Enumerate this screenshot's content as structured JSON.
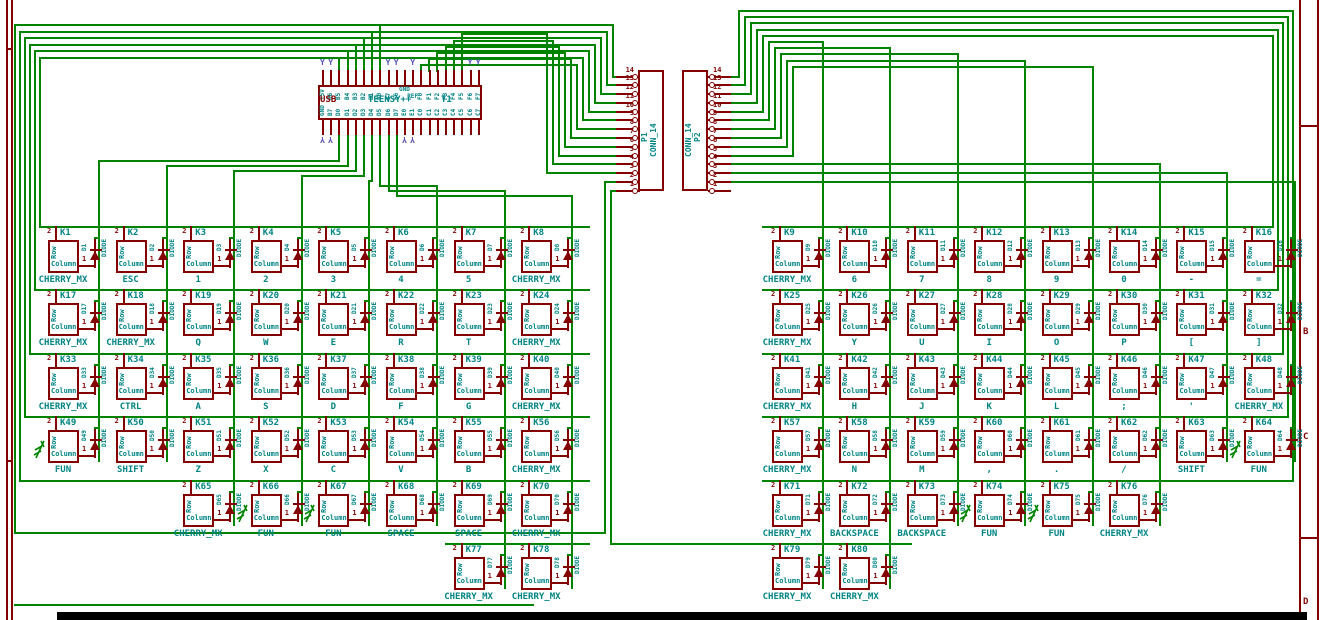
{
  "colors": {
    "wire": "#008400",
    "outline": "#840000",
    "text": "#008484",
    "noconnect": "#5252b5",
    "background": "#ffffff",
    "frame": "#840000",
    "bottom_bar": "#000000"
  },
  "schematic": {
    "teensy": {
      "ref": "T1",
      "value": "TEENSY++",
      "left_label": "USB",
      "top_pins": [
        "+5V",
        "B6",
        "B5",
        "B4",
        "B3",
        "B2",
        "B1",
        "B0",
        "E7",
        "E6",
        "GND",
        "REF",
        "F0",
        "F1",
        "F2",
        "F3",
        "F4",
        "F5",
        "F6",
        "F7"
      ],
      "bottom_pins": [
        "GND",
        "B7",
        "D0",
        "D1",
        "D2",
        "D3",
        "D4",
        "D5",
        "D6",
        "D7",
        "E0",
        "E1",
        "C0",
        "C1",
        "C2",
        "C3",
        "C4",
        "C5",
        "C6",
        "C7"
      ],
      "nc_top": [
        0,
        1,
        8,
        9,
        11,
        18,
        19
      ],
      "nc_bottom": [
        0,
        1,
        10,
        11
      ]
    },
    "connectors": [
      {
        "ref": "P1",
        "value": "CONN_14",
        "pin_numbers": [
          "14",
          "13",
          "12",
          "11",
          "10",
          "9",
          "8",
          "7",
          "6",
          "5",
          "4",
          "3",
          "2",
          "1"
        ]
      },
      {
        "ref": "P2",
        "value": "CONN_14",
        "pin_numbers": [
          "14",
          "13",
          "12",
          "11",
          "10",
          "9",
          "8",
          "7",
          "6",
          "5",
          "4",
          "3",
          "2",
          "1"
        ]
      }
    ],
    "switch_labels": {
      "pin2_name": "Row",
      "pin1_name": "Column",
      "pin1_num": "1",
      "pin2_num": "2",
      "diode_value": "DIODE"
    },
    "keys": [
      {
        "ref": "K1",
        "value": "CHERRY_MX",
        "diode": "D1",
        "half": "L",
        "row": 1,
        "col": 0
      },
      {
        "ref": "K2",
        "value": "ESC",
        "diode": "D2",
        "half": "L",
        "row": 1,
        "col": 1
      },
      {
        "ref": "K3",
        "value": "1",
        "diode": "D3",
        "half": "L",
        "row": 1,
        "col": 2
      },
      {
        "ref": "K4",
        "value": "2",
        "diode": "D4",
        "half": "L",
        "row": 1,
        "col": 3
      },
      {
        "ref": "K5",
        "value": "3",
        "diode": "D5",
        "half": "L",
        "row": 1,
        "col": 4
      },
      {
        "ref": "K6",
        "value": "4",
        "diode": "D6",
        "half": "L",
        "row": 1,
        "col": 5
      },
      {
        "ref": "K7",
        "value": "5",
        "diode": "D7",
        "half": "L",
        "row": 1,
        "col": 6
      },
      {
        "ref": "K8",
        "value": "CHERRY_MX",
        "diode": "D8",
        "half": "L",
        "row": 1,
        "col": 7
      },
      {
        "ref": "K9",
        "value": "CHERRY_MX",
        "diode": "D9",
        "half": "R",
        "row": 1,
        "col": 0
      },
      {
        "ref": "K10",
        "value": "6",
        "diode": "D10",
        "half": "R",
        "row": 1,
        "col": 1
      },
      {
        "ref": "K11",
        "value": "7",
        "diode": "D11",
        "half": "R",
        "row": 1,
        "col": 2
      },
      {
        "ref": "K12",
        "value": "8",
        "diode": "D12",
        "half": "R",
        "row": 1,
        "col": 3
      },
      {
        "ref": "K13",
        "value": "9",
        "diode": "D13",
        "half": "R",
        "row": 1,
        "col": 4
      },
      {
        "ref": "K14",
        "value": "0",
        "diode": "D14",
        "half": "R",
        "row": 1,
        "col": 5
      },
      {
        "ref": "K15",
        "value": "-",
        "diode": "D15",
        "half": "R",
        "row": 1,
        "col": 6
      },
      {
        "ref": "K16",
        "value": "=",
        "diode": "D16",
        "half": "R",
        "row": 1,
        "col": 7
      },
      {
        "ref": "K17",
        "value": "CHERRY_MX",
        "diode": "D17",
        "half": "L",
        "row": 2,
        "col": 0
      },
      {
        "ref": "K18",
        "value": "CHERRY_MX",
        "diode": "D18",
        "half": "L",
        "row": 2,
        "col": 1
      },
      {
        "ref": "K19",
        "value": "Q",
        "diode": "D19",
        "half": "L",
        "row": 2,
        "col": 2
      },
      {
        "ref": "K20",
        "value": "W",
        "diode": "D20",
        "half": "L",
        "row": 2,
        "col": 3
      },
      {
        "ref": "K21",
        "value": "E",
        "diode": "D21",
        "half": "L",
        "row": 2,
        "col": 4
      },
      {
        "ref": "K22",
        "value": "R",
        "diode": "D22",
        "half": "L",
        "row": 2,
        "col": 5
      },
      {
        "ref": "K23",
        "value": "T",
        "diode": "D23",
        "half": "L",
        "row": 2,
        "col": 6
      },
      {
        "ref": "K24",
        "value": "CHERRY_MX",
        "diode": "D24",
        "half": "L",
        "row": 2,
        "col": 7
      },
      {
        "ref": "K25",
        "value": "CHERRY_MX",
        "diode": "D25",
        "half": "R",
        "row": 2,
        "col": 0
      },
      {
        "ref": "K26",
        "value": "Y",
        "diode": "D26",
        "half": "R",
        "row": 2,
        "col": 1
      },
      {
        "ref": "K27",
        "value": "U",
        "diode": "D27",
        "half": "R",
        "row": 2,
        "col": 2
      },
      {
        "ref": "K28",
        "value": "I",
        "diode": "D28",
        "half": "R",
        "row": 2,
        "col": 3
      },
      {
        "ref": "K29",
        "value": "O",
        "diode": "D29",
        "half": "R",
        "row": 2,
        "col": 4
      },
      {
        "ref": "K30",
        "value": "P",
        "diode": "D30",
        "half": "R",
        "row": 2,
        "col": 5
      },
      {
        "ref": "K31",
        "value": "[",
        "diode": "D31",
        "half": "R",
        "row": 2,
        "col": 6
      },
      {
        "ref": "K32",
        "value": "]",
        "diode": "D32",
        "half": "R",
        "row": 2,
        "col": 7
      },
      {
        "ref": "K33",
        "value": "CHERRY_MX",
        "diode": "D33",
        "half": "L",
        "row": 3,
        "col": 0
      },
      {
        "ref": "K34",
        "value": "CTRL",
        "diode": "D34",
        "half": "L",
        "row": 3,
        "col": 1
      },
      {
        "ref": "K35",
        "value": "A",
        "diode": "D35",
        "half": "L",
        "row": 3,
        "col": 2
      },
      {
        "ref": "K36",
        "value": "S",
        "diode": "D36",
        "half": "L",
        "row": 3,
        "col": 3
      },
      {
        "ref": "K37",
        "value": "D",
        "diode": "D37",
        "half": "L",
        "row": 3,
        "col": 4
      },
      {
        "ref": "K38",
        "value": "F",
        "diode": "D38",
        "half": "L",
        "row": 3,
        "col": 5
      },
      {
        "ref": "K39",
        "value": "G",
        "diode": "D39",
        "half": "L",
        "row": 3,
        "col": 6
      },
      {
        "ref": "K40",
        "value": "CHERRY_MX",
        "diode": "D40",
        "half": "L",
        "row": 3,
        "col": 7
      },
      {
        "ref": "K41",
        "value": "CHERRY_MX",
        "diode": "D41",
        "half": "R",
        "row": 3,
        "col": 0
      },
      {
        "ref": "K42",
        "value": "H",
        "diode": "D42",
        "half": "R",
        "row": 3,
        "col": 1
      },
      {
        "ref": "K43",
        "value": "J",
        "diode": "D43",
        "half": "R",
        "row": 3,
        "col": 2
      },
      {
        "ref": "K44",
        "value": "K",
        "diode": "D44",
        "half": "R",
        "row": 3,
        "col": 3
      },
      {
        "ref": "K45",
        "value": "L",
        "diode": "D45",
        "half": "R",
        "row": 3,
        "col": 4
      },
      {
        "ref": "K46",
        "value": ";",
        "diode": "D46",
        "half": "R",
        "row": 3,
        "col": 5
      },
      {
        "ref": "K47",
        "value": "'",
        "diode": "D47",
        "half": "R",
        "row": 3,
        "col": 6
      },
      {
        "ref": "K48",
        "value": "CHERRY_MX",
        "diode": "D48",
        "half": "R",
        "row": 3,
        "col": 7
      },
      {
        "ref": "K49",
        "value": "FUN",
        "diode": "D49",
        "half": "L",
        "row": 4,
        "col": 0,
        "arrow": true
      },
      {
        "ref": "K50",
        "value": "SHIFT",
        "diode": "D50",
        "half": "L",
        "row": 4,
        "col": 1
      },
      {
        "ref": "K51",
        "value": "Z",
        "diode": "D51",
        "half": "L",
        "row": 4,
        "col": 2
      },
      {
        "ref": "K52",
        "value": "X",
        "diode": "D52",
        "half": "L",
        "row": 4,
        "col": 3
      },
      {
        "ref": "K53",
        "value": "C",
        "diode": "D53",
        "half": "L",
        "row": 4,
        "col": 4
      },
      {
        "ref": "K54",
        "value": "V",
        "diode": "D54",
        "half": "L",
        "row": 4,
        "col": 5
      },
      {
        "ref": "K55",
        "value": "B",
        "diode": "D55",
        "half": "L",
        "row": 4,
        "col": 6
      },
      {
        "ref": "K56",
        "value": "CHERRY_MX",
        "diode": "D56",
        "half": "L",
        "row": 4,
        "col": 7
      },
      {
        "ref": "K57",
        "value": "CHERRY_MX",
        "diode": "D57",
        "half": "R",
        "row": 4,
        "col": 0
      },
      {
        "ref": "K58",
        "value": "N",
        "diode": "D58",
        "half": "R",
        "row": 4,
        "col": 1
      },
      {
        "ref": "K59",
        "value": "M",
        "diode": "D59",
        "half": "R",
        "row": 4,
        "col": 2
      },
      {
        "ref": "K60",
        "value": ",",
        "diode": "D60",
        "half": "R",
        "row": 4,
        "col": 3
      },
      {
        "ref": "K61",
        "value": ".",
        "diode": "D61",
        "half": "R",
        "row": 4,
        "col": 4
      },
      {
        "ref": "K62",
        "value": "/",
        "diode": "D62",
        "half": "R",
        "row": 4,
        "col": 5
      },
      {
        "ref": "K63",
        "value": "SHIFT",
        "diode": "D63",
        "half": "R",
        "row": 4,
        "col": 6
      },
      {
        "ref": "K64",
        "value": "FUN",
        "diode": "D64",
        "half": "R",
        "row": 4,
        "col": 7,
        "arrow": true
      },
      {
        "ref": "K65",
        "value": "CHERRY_MX",
        "diode": "D65",
        "half": "L",
        "row": 5,
        "col": 2
      },
      {
        "ref": "K66",
        "value": "FUN",
        "diode": "D66",
        "half": "L",
        "row": 5,
        "col": 3,
        "arrow": true
      },
      {
        "ref": "K67",
        "value": "FUN",
        "diode": "D67",
        "half": "L",
        "row": 5,
        "col": 4,
        "arrow": true
      },
      {
        "ref": "K68",
        "value": "SPACE",
        "diode": "D68",
        "half": "L",
        "row": 5,
        "col": 5
      },
      {
        "ref": "K69",
        "value": "SPACE",
        "diode": "D69",
        "half": "L",
        "row": 5,
        "col": 6
      },
      {
        "ref": "K70",
        "value": "CHERRY_MX",
        "diode": "D70",
        "half": "L",
        "row": 5,
        "col": 7
      },
      {
        "ref": "K71",
        "value": "CHERRY_MX",
        "diode": "D71",
        "half": "R",
        "row": 5,
        "col": 0
      },
      {
        "ref": "K72",
        "value": "BACKSPACE",
        "diode": "D72",
        "half": "R",
        "row": 5,
        "col": 1
      },
      {
        "ref": "K73",
        "value": "BACKSPACE",
        "diode": "D73",
        "half": "R",
        "row": 5,
        "col": 2
      },
      {
        "ref": "K74",
        "value": "FUN",
        "diode": "D74",
        "half": "R",
        "row": 5,
        "col": 3,
        "arrow": true
      },
      {
        "ref": "K75",
        "value": "FUN",
        "diode": "D75",
        "half": "R",
        "row": 5,
        "col": 4,
        "arrow": true
      },
      {
        "ref": "K76",
        "value": "CHERRY_MX",
        "diode": "D76",
        "half": "R",
        "row": 5,
        "col": 5
      },
      {
        "ref": "K77",
        "value": "CHERRY_MX",
        "diode": "D77",
        "half": "L",
        "row": 6,
        "col": 6
      },
      {
        "ref": "K78",
        "value": "CHERRY_MX",
        "diode": "D78",
        "half": "L",
        "row": 6,
        "col": 7
      },
      {
        "ref": "K79",
        "value": "CHERRY_MX",
        "diode": "D79",
        "half": "R",
        "row": 6,
        "col": 0
      },
      {
        "ref": "K80",
        "value": "CHERRY_MX",
        "diode": "D80",
        "half": "R",
        "row": 6,
        "col": 1
      }
    ],
    "frame": {
      "right_letters": [
        {
          "label": "B",
          "y": 328
        },
        {
          "label": "C",
          "y": 433
        },
        {
          "label": "D",
          "y": 598
        }
      ]
    }
  }
}
